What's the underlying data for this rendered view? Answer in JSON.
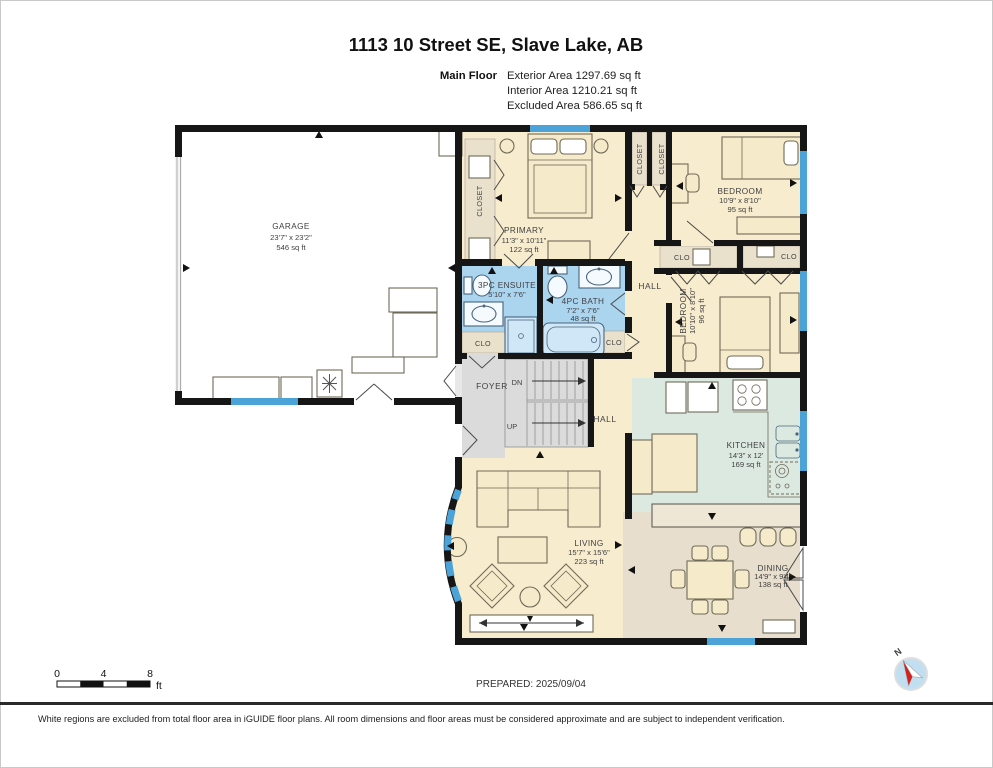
{
  "header": {
    "title": "1113 10 Street SE, Slave Lake, AB",
    "floor_label": "Main Floor",
    "exterior": "Exterior Area 1297.69 sq ft",
    "interior": "Interior Area 1210.21 sq ft",
    "excluded": "Excluded Area 586.65 sq ft"
  },
  "rooms": {
    "garage": {
      "name": "GARAGE",
      "dims": "23'7\" x 23'2\"",
      "area": "546 sq ft"
    },
    "primary": {
      "name": "PRIMARY",
      "dims": "11'3\" x 10'11\"",
      "area": "122 sq ft"
    },
    "bedroom1": {
      "name": "BEDROOM",
      "dims": "10'9\" x 8'10\"",
      "area": "95 sq ft"
    },
    "bedroom2": {
      "name": "BEDROOM",
      "dims": "10'10\" x 8'10\"",
      "area": "96 sq ft"
    },
    "ensuite": {
      "name": "3PC ENSUITE",
      "dims": "5'10\" x 7'6\""
    },
    "bath": {
      "name": "4PC BATH",
      "dims": "7'2\" x 7'6\"",
      "area": "48 sq ft"
    },
    "kitchen": {
      "name": "KITCHEN",
      "dims": "14'3\" x 12'",
      "area": "169 sq ft"
    },
    "living": {
      "name": "LIVING",
      "dims": "15'7\" x 15'6\"",
      "area": "223 sq ft"
    },
    "dining": {
      "name": "DINING",
      "dims": "14'9\" x 9'4\"",
      "area": "138 sq ft"
    }
  },
  "labels": {
    "closet": "CLOSET",
    "clo": "CLO",
    "hall": "HALL",
    "foyer": "FOYER",
    "down": "DN",
    "up": "UP"
  },
  "scale_bar": {
    "tick0": "0",
    "tick1": "4",
    "tick2": "8",
    "unit": "ft"
  },
  "compass": {
    "north": "N"
  },
  "footer": {
    "prepared": "PREPARED: 2025/09/04",
    "disclaimer": "White regions are excluded from total floor area in iGUIDE floor plans. All room dimensions and floor areas must be considered approximate and are subject to independent verification."
  },
  "colors": {
    "wall": "#161616",
    "window": "#4BA3D8",
    "room_floor": "#F8ECCE",
    "closet_floor": "#EAE1CD",
    "bath_floor": "#ABD4EF",
    "kitchen_floor": "#DCE9E0",
    "dining_floor": "#E7DECE",
    "foyer_floor": "#DBDBDB"
  }
}
